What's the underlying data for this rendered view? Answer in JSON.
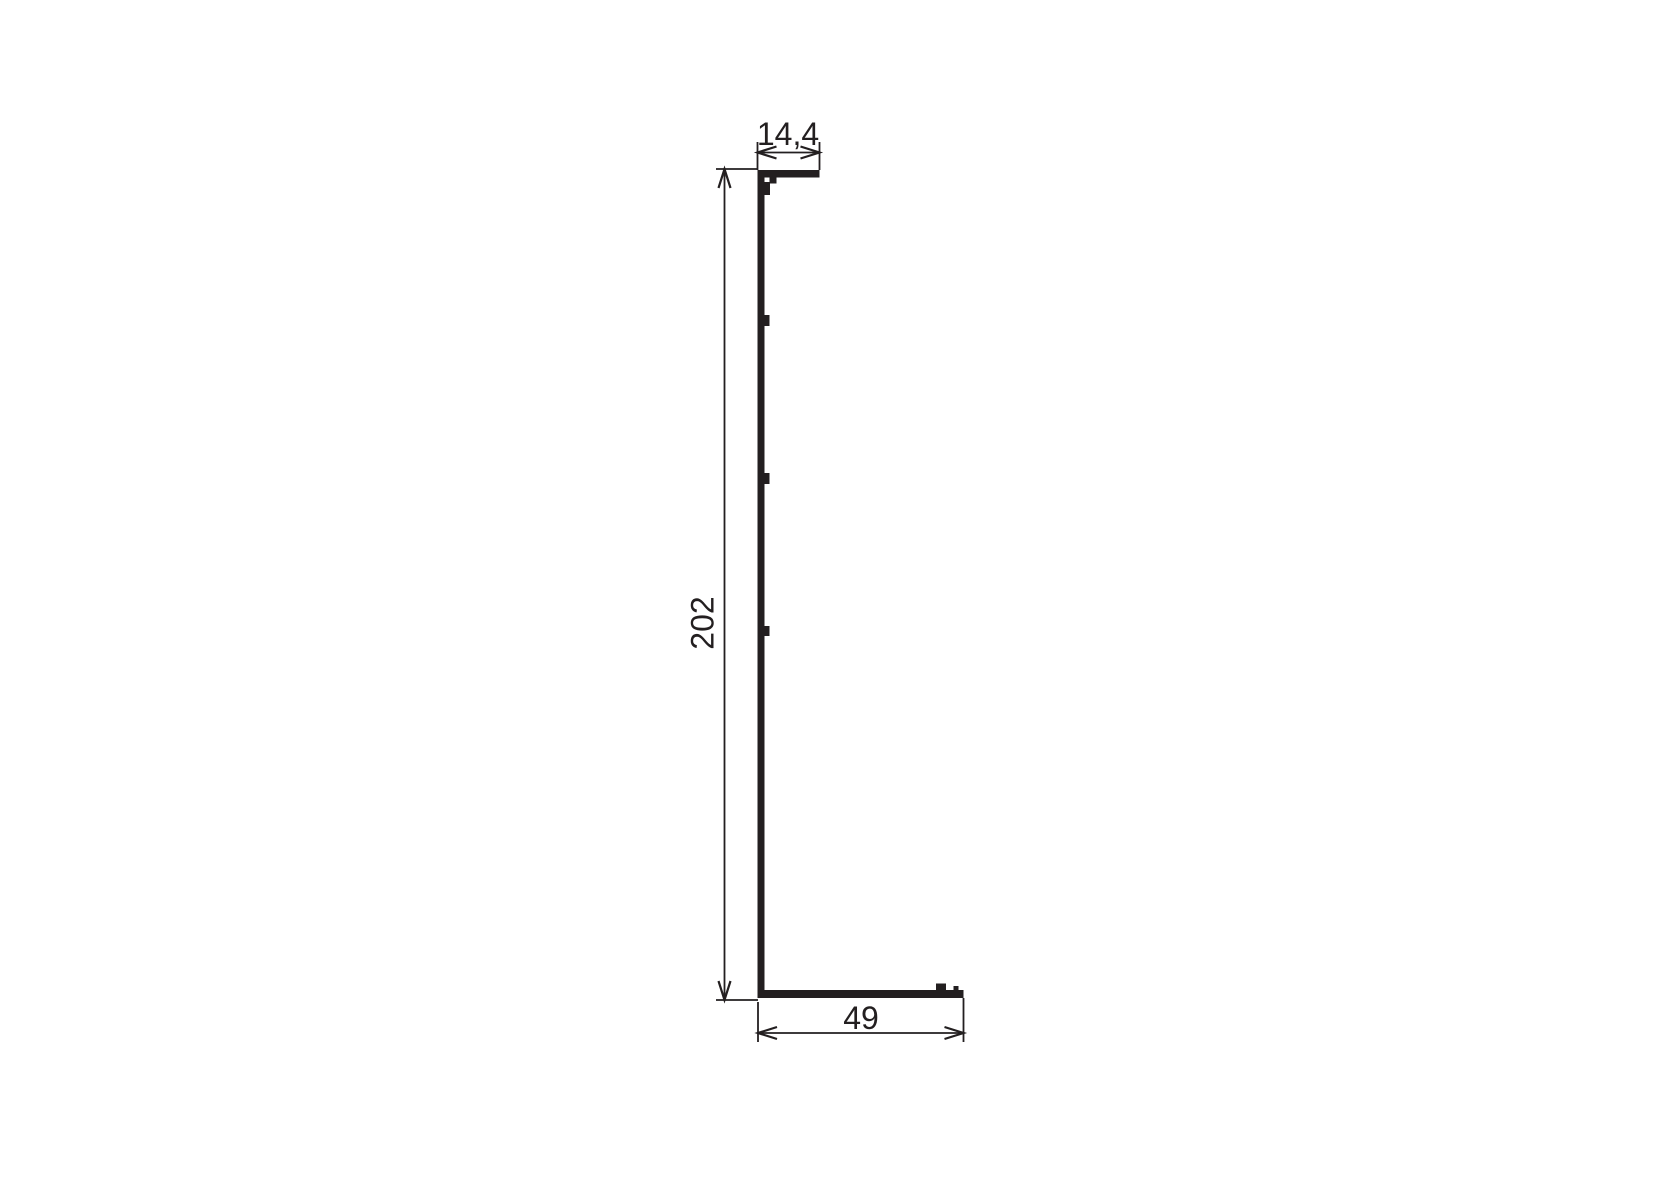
{
  "drawing": {
    "type": "technical-profile-cross-section",
    "background_color": "#ffffff",
    "line_color": "#231f20",
    "dimension_labels": {
      "top_width": "14,4",
      "height": "202",
      "bottom_width": "49"
    }
  }
}
